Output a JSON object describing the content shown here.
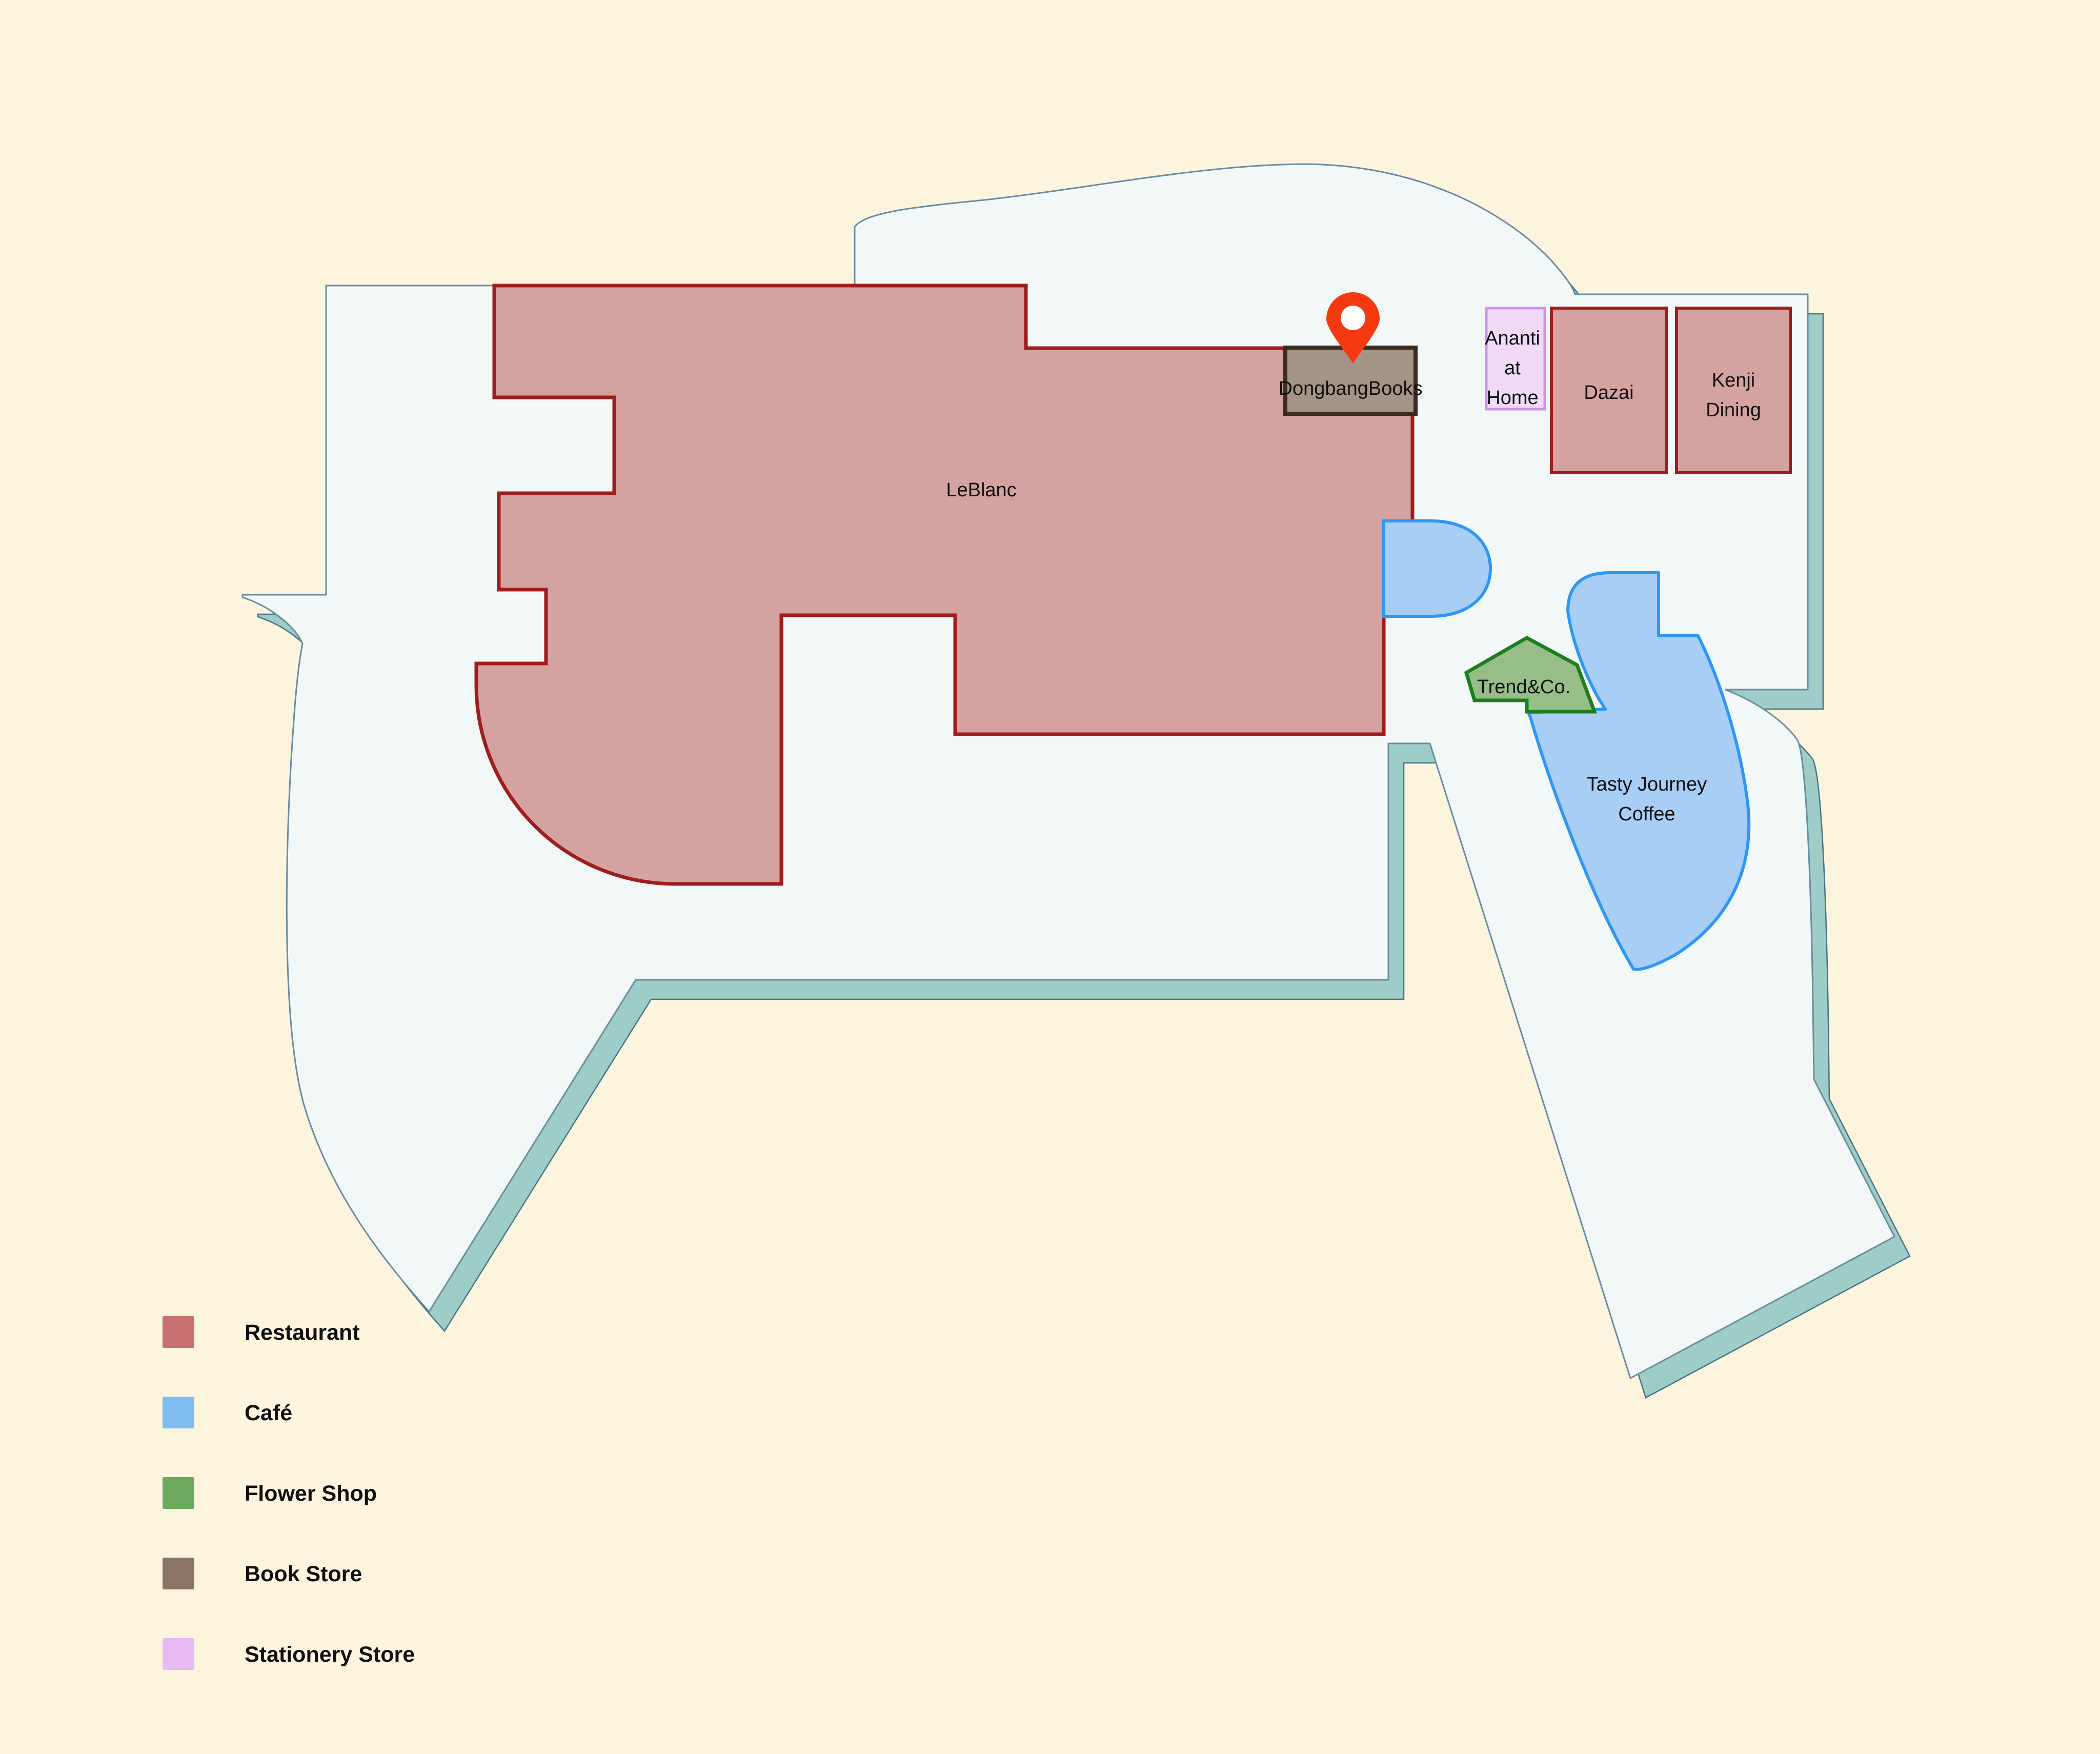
{
  "map": {
    "places": {
      "leblanc": {
        "label": "LeBlanc"
      },
      "dongbang": {
        "label": "DongbangBooks"
      },
      "ananti": {
        "line1": "Ananti",
        "line2": "at",
        "line3": "Home"
      },
      "dazai": {
        "label": "Dazai"
      },
      "kenji": {
        "line1": "Kenji",
        "line2": "Dining"
      },
      "trend": {
        "label": "Trend&Co."
      },
      "tasty": {
        "line1": "Tasty Journey",
        "line2": "Coffee"
      }
    }
  },
  "legend": {
    "items": [
      {
        "label": "Restaurant",
        "color": "#C97170"
      },
      {
        "label": "Café",
        "color": "#7EBCF2"
      },
      {
        "label": "Flower Shop",
        "color": "#6BAA5D"
      },
      {
        "label": "Book Store",
        "color": "#8B7365"
      },
      {
        "label": "Stationery Store",
        "color": "#E6BAF3"
      }
    ]
  },
  "colors": {
    "background": "#FDF4DE",
    "floor": "#F2F8F8",
    "floorBorder": "#6A8CA0",
    "shadow": "#9ECCC6",
    "shadowBorder": "#447485",
    "restaurantFill": "#D5A2A2",
    "restaurantBorder": "#A01D1D",
    "cafeFill": "#A8CEF5",
    "cafeBorder": "#2E96F5",
    "flowerFill": "#97BE88",
    "flowerBorder": "#1E7D1F",
    "bookFill": "#A49486",
    "bookBorder": "#3E2B20",
    "stationeryFill": "#F1DAF8",
    "stationeryBorder": "#D090F0",
    "pin": "#F4380F",
    "pinHole": "#FFFFFF"
  }
}
